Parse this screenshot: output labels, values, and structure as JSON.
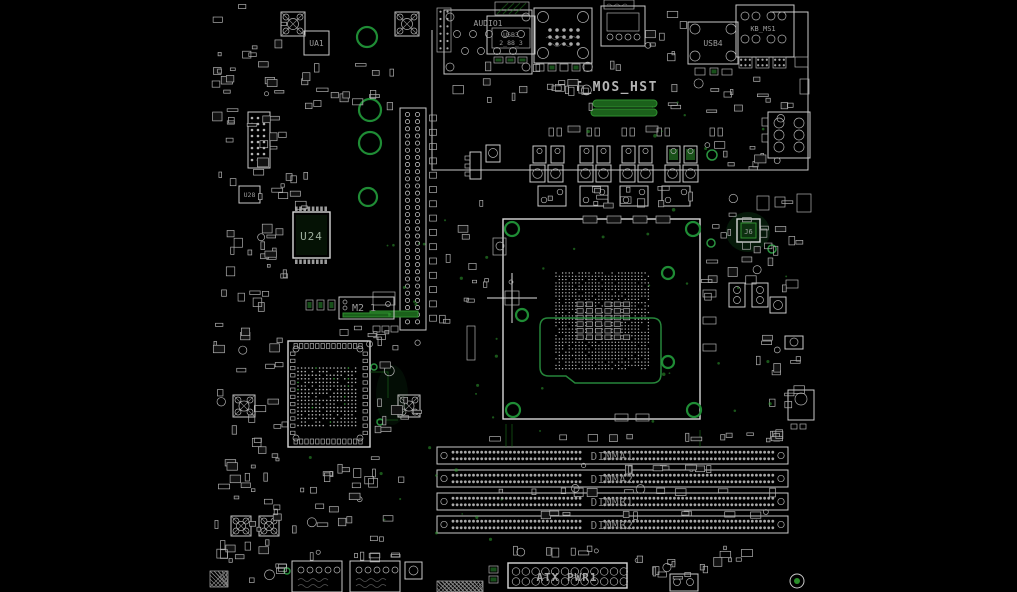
{
  "colors": {
    "background": "#000000",
    "component_outline": "#c9c9c9",
    "accent_green": "#2f9e2f",
    "ring_green": "#1f8c35",
    "label_gray": "#8f8f8f",
    "bright_text": "#b5b5b5"
  },
  "rear_io": {
    "audio": "AUDIO1",
    "usb3_line1": "USB3",
    "usb3_line2": "2_88_3",
    "usb4": "USB4",
    "ps2": "KB_MS1"
  },
  "silkscreen": {
    "t_mos_hst": "T_MOS_HST",
    "ua1": "UA1",
    "u28": "U28",
    "u24": "U24",
    "m2_slot": "M2_1",
    "j6": "J6",
    "atx_power": "ATX PWR1"
  },
  "dimm_slots": [
    {
      "label": "DIMMA1"
    },
    {
      "label": "DIMMA2"
    },
    {
      "label": "DIMMB1"
    },
    {
      "label": "DIMMB2"
    }
  ]
}
